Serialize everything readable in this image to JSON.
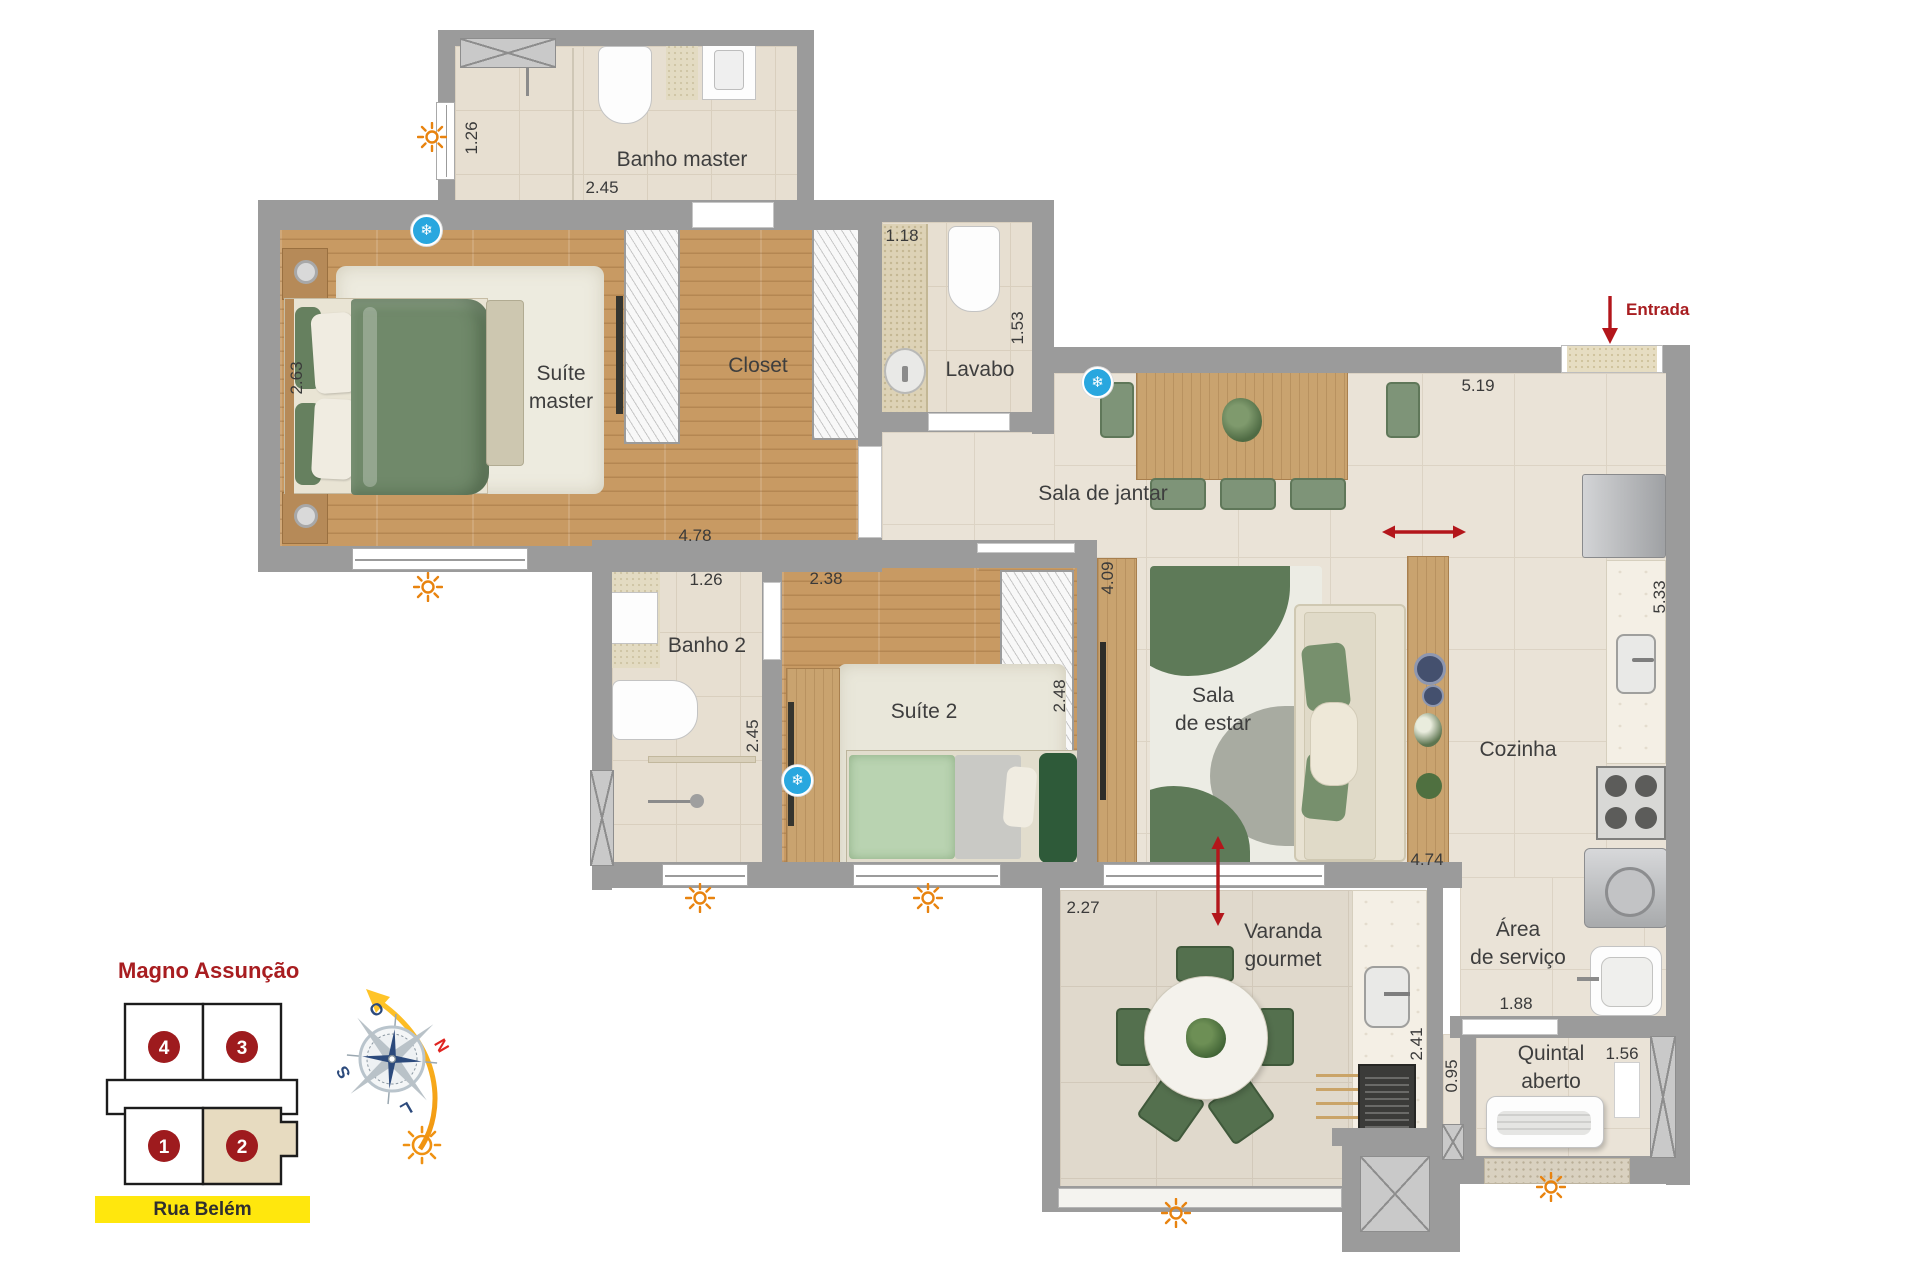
{
  "plan": {
    "rooms": {
      "banho_master": {
        "label": "Banho master"
      },
      "suite_master": {
        "line1": "Suíte",
        "line2": "master"
      },
      "closet": {
        "label": "Closet"
      },
      "lavabo": {
        "label": "Lavabo"
      },
      "sala_jantar": {
        "label": "Sala de jantar"
      },
      "banho2": {
        "label": "Banho 2"
      },
      "suite2": {
        "label": "Suíte 2"
      },
      "sala_estar": {
        "line1": "Sala",
        "line2": "de estar"
      },
      "cozinha": {
        "label": "Cozinha"
      },
      "varanda": {
        "line1": "Varanda",
        "line2": "gourmet"
      },
      "area_servico": {
        "line1": "Área",
        "line2": "de serviço"
      },
      "quintal": {
        "line1": "Quintal",
        "line2": "aberto"
      }
    },
    "entrance_label": "Entrada",
    "dims": {
      "banho_master_h": "1.26",
      "banho_master_w": "2.45",
      "suite_master_h": "2.63",
      "suite_master_w": "4.78",
      "lavabo_w": "1.18",
      "lavabo_h": "1.53",
      "jantar_w": "5.19",
      "banho2_w": "1.26",
      "banho2_h": "2.45",
      "suite2_w": "2.38",
      "suite2_h": "2.48",
      "estar_h": "4.09",
      "estar_w": "4.74",
      "cozinha_h": "5.33",
      "varanda_w": "2.27",
      "varanda_counter_h": "2.41",
      "corridor_w": "0.95",
      "servico_door_w": "1.88",
      "quintal_w": "1.56"
    }
  },
  "keyplan": {
    "title": "Magno Assunção",
    "street": "Rua Belém",
    "units": {
      "u1": "1",
      "u2": "2",
      "u3": "3",
      "u4": "4"
    },
    "highlighted_unit": "2"
  },
  "compass": {
    "west": "O",
    "north": "N",
    "south": "S",
    "east": "L"
  },
  "icons": {
    "snowflake_glyph": "❄",
    "sun": "sun-icon",
    "snowflake": "air-conditioning-icon",
    "entrance_arrow": "red down arrow",
    "flow_arrows": "red double arrows"
  },
  "colors": {
    "wall": "#9b9b9b",
    "accent_red": "#a81d20",
    "street_yellow": "#ffe70d",
    "sun_orange": "#e8830f",
    "ac_blue": "#29a7df",
    "unit_highlight": "#e7dbc0",
    "wood": "#c89a63",
    "tile": "#eae3d7"
  }
}
